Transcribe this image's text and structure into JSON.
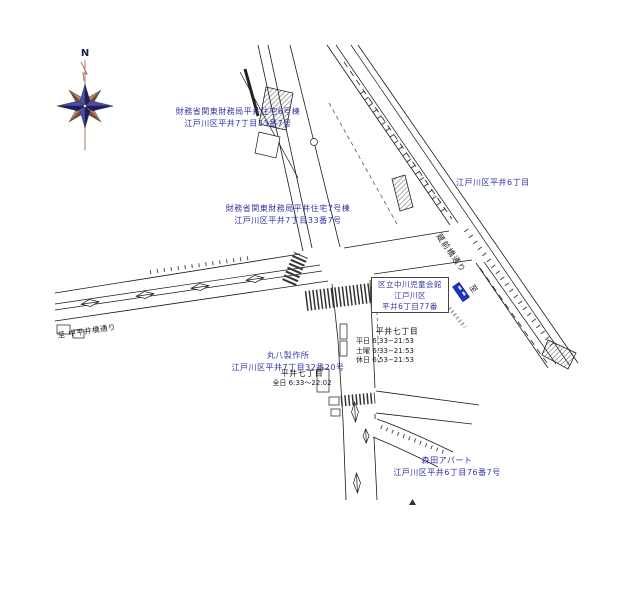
{
  "colors": {
    "label_blue": "#3434a6",
    "label_black": "#1a1a1a",
    "bus_marker": "#1d33c4",
    "compass_blue": "#4b4bb0",
    "compass_blue_dark": "#1c1c66",
    "compass_brown": "#b5835f",
    "compass_brown_dark": "#7a4a2e"
  },
  "compass": {
    "north_label": "N"
  },
  "roads": {
    "main": {
      "name": "蔵前橋通り",
      "direction_marker": "至"
    },
    "west": {
      "direction_label": "至 中平井橋通り"
    }
  },
  "places": {
    "housing6": {
      "name": "財務省関東財務局平井住宅6号棟",
      "address": "江戸川区平井7丁目33番7号"
    },
    "housing7": {
      "name": "財務省関東財務局平井住宅7号棟",
      "address": "江戸川区平井7丁目33番7号"
    },
    "district": {
      "name": "江戸川区平井6丁目"
    },
    "childrens_hall": {
      "name": "区立中川児童会館",
      "ward": "江戸川区",
      "address": "平井6丁目77番"
    },
    "factory": {
      "name": "丸八製作所",
      "address": "江戸川区平井7丁目32番20号"
    },
    "apartment": {
      "name": "森田アパート",
      "address": "江戸川区平井6丁目76番7号"
    }
  },
  "bus_stops": {
    "east": {
      "name": "平井七丁目",
      "weekday": "平日 6:33−21:53",
      "saturday": "土曜 6:33−21:53",
      "holiday": "休日 6:53−21:53"
    },
    "west": {
      "name": "平井七丁目",
      "all_days": "全日 6:33〜22:02"
    }
  }
}
